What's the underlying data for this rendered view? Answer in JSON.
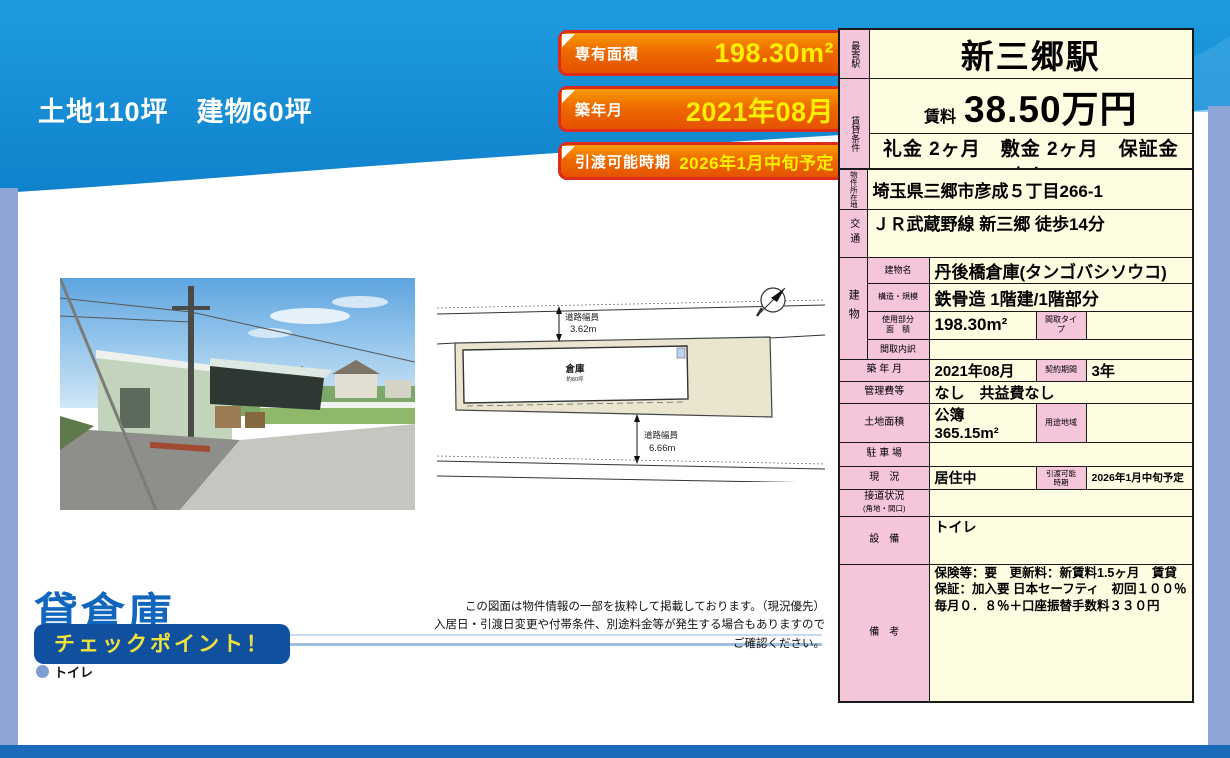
{
  "headline": {
    "line1": "土地110坪　建物60坪",
    "line2": "築浅倉庫"
  },
  "badges": [
    {
      "label": "専有面積",
      "value": "198.30m²"
    },
    {
      "label": "築年月",
      "value": "2021年08月"
    },
    {
      "label": "引渡可能時期",
      "value": "2026年1月中旬予定"
    }
  ],
  "summary_table": {
    "station_header": "最寄駅",
    "station": "新三郷駅",
    "conditions_header": "賃貸条件",
    "rent_label": "賃料",
    "rent_value": "38.50万円",
    "terms": "礼金 2ヶ月　敷金 2ヶ月　保証金 なし"
  },
  "details_table": {
    "location_header": "物件所在地",
    "location": "埼玉県三郷市彦成５丁目266-1",
    "access_header": "交通",
    "access": "ＪＲ武蔵野線 新三郷 徒歩14分",
    "building_header": "建物",
    "building_name_label": "建物名",
    "building_name": "丹後橋倉庫(タンゴバシソウコ)",
    "structure_label": "構造・規模",
    "structure": "鉄骨造 1階建/1階部分",
    "used_area_label1": "使用部分",
    "used_area_label2": "面　積",
    "used_area": "198.30m²",
    "madori_type_label": "間取タイプ",
    "madori_type": "",
    "madori_detail_label": "間取内訳",
    "madori_detail": "",
    "built_label": "築 年 月",
    "built": "2021年08月",
    "contract_label": "契約期間",
    "contract": "3年",
    "fees_label": "管理費等",
    "fees": "なし　共益費なし",
    "land_label": "土地面積",
    "land": "公簿 365.15m²",
    "zone_label": "用途地域",
    "zone": "",
    "parking_label": "駐 車 場",
    "parking": "",
    "status_label": "現　況",
    "status": "居住中",
    "handover_label1": "引渡可能",
    "handover_label2": "時期",
    "handover": "2026年1月中旬予定",
    "road_label1": "接道状況",
    "road_label2": "(角地・間口)",
    "road": "",
    "equipment_label": "設　備",
    "equipment": "トイレ",
    "notes_label": "備　考",
    "notes": "保険等：要　更新料：新賃料1.5ヶ月　賃貸保証：加入要 日本セーフティ　初回１００％　毎月０．８％＋口座振替手数料３３０円"
  },
  "siteplan": {
    "road_width_top_label": "道路幅員",
    "road_width_top": "3.62m",
    "road_width_bottom_label": "道路幅員",
    "road_width_bottom": "6.66m",
    "building_label": "倉庫",
    "building_sublabel": "約60坪"
  },
  "footer": {
    "category": "貸倉庫",
    "checkpoint_label": "チェックポイント！",
    "checkpoint_items": [
      "トイレ"
    ],
    "disclaimer_line1": "この図面は物件情報の一部を抜粋して掲載しております。（現況優先）",
    "disclaimer_line2": "入居日・引渡日変更や付帯条件、別途料金等が発生する場合もありますのでご確認ください。"
  },
  "colors": {
    "header_blue": "#1590d7",
    "accent_bar_blue": "#8fa5d6",
    "bottom_bar_blue": "#1a6cbb",
    "badge_orange": "#ee6b00",
    "badge_border_red": "#dd2b1c",
    "badge_value_yellow": "#ffef00",
    "table_cream": "#fffde1",
    "table_pink": "#f5c6da",
    "category_blue": "#1366be",
    "checkpoint_bg": "#11509f",
    "checkpoint_text": "#efe33b"
  }
}
